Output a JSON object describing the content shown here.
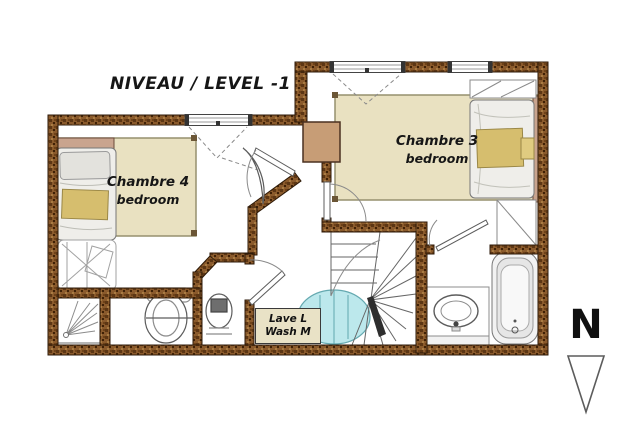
{
  "title": "NIVEAU / LEVEL -1",
  "compass": {
    "label": "N",
    "arrow_direction": "down"
  },
  "rooms": [
    {
      "id": "chambre-4",
      "name_fr": "Chambre 4",
      "name_en": "bedroom"
    },
    {
      "id": "chambre-3",
      "name_fr": "Chambre 3",
      "name_en": "bedroom"
    }
  ],
  "appliances": {
    "washing_machine": {
      "line1": "Lave L",
      "line2": "Wash M"
    }
  },
  "fixtures": [
    "bed-chambre-4",
    "bunk-sofa-wireframe",
    "bed-chambre-3",
    "shower",
    "bidet-basin",
    "toilet",
    "washbasin-counter",
    "bathtub",
    "winder-staircase",
    "spiral-opening",
    "duct",
    "wardrobe-closets"
  ],
  "colors": {
    "wall_brown": "#8a5a2c",
    "wall_dark": "#5c3614",
    "floor_tan": "#e9e1c1",
    "duct_tan": "#c79d76",
    "headboard": "#c9a48e",
    "blanket_yellow": "#d6be6e",
    "opening_cyan": "#b5e6ea",
    "label_box": "#e9e2c6",
    "ink": "#161616"
  }
}
